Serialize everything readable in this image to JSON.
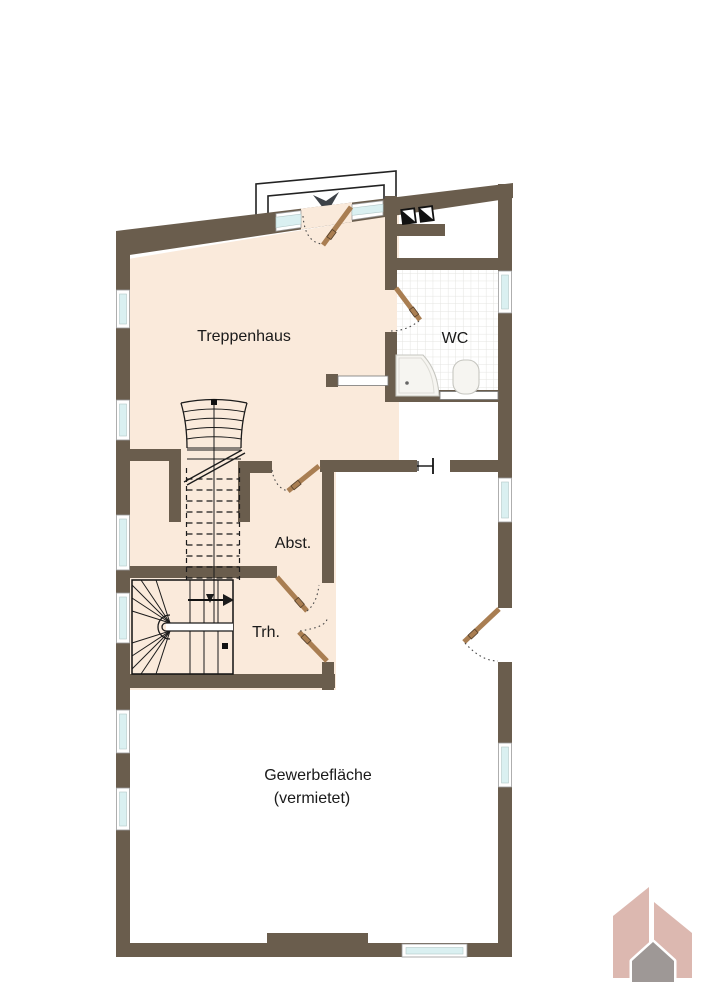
{
  "plan": {
    "rooms": {
      "treppenhaus": {
        "label": "Treppenhaus"
      },
      "wc": {
        "label": "WC"
      },
      "abstellraum": {
        "label": "Abst."
      },
      "trh": {
        "label": "Trh."
      },
      "gewerbeflaeche": {
        "label": "Gewerbefläche",
        "sublabel": "(vermietet)"
      }
    },
    "symbols": {
      "entrance_arrow": "entrance-direction-arrow",
      "chimney_shaft": "chimney-shaft-squares",
      "door_swing": "door-swing-arc",
      "stairs_up": "stair-run-arrow",
      "logo": "company-logo-houses"
    }
  },
  "colors": {
    "bg": "#ffffff",
    "wall": "#6a5d4d",
    "floor": "#faeadb",
    "glass": "#daf0f1",
    "frame": "#ffffff",
    "door": "#a97e52",
    "line": "#1b1b1b",
    "tile": "#e4e4e1",
    "arrow": "#3d4248",
    "logo_pink": "#dcb8b0",
    "logo_gray": "#9e9896"
  }
}
